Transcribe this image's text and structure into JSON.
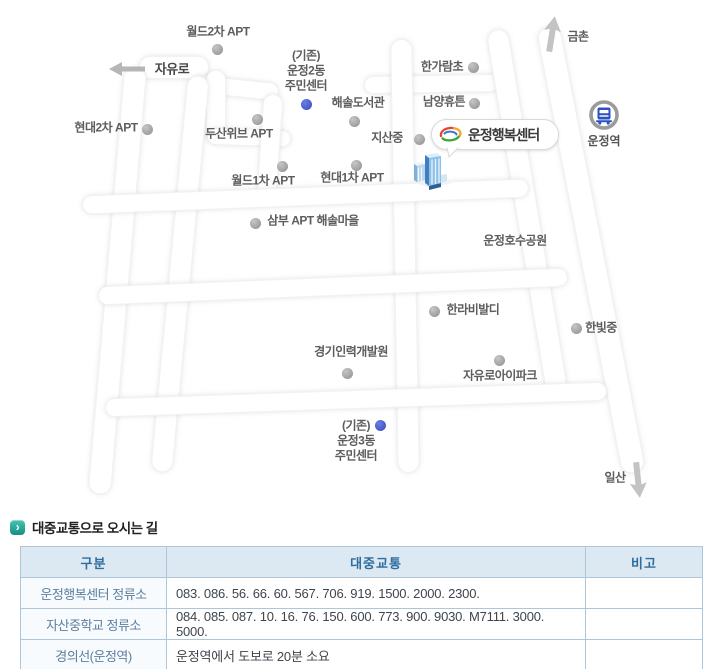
{
  "map": {
    "callout": {
      "label": "운정행복센터"
    },
    "station": {
      "label": "운정역"
    },
    "markers": [
      {
        "id": "world2-apt",
        "text": "월드2차 APT",
        "tx": 218,
        "ty": 32,
        "dx": 217,
        "dy": 49,
        "dot": "gray"
      },
      {
        "id": "jayuro-road",
        "text": "자유로",
        "tx": 172,
        "ty": 69,
        "road": true
      },
      {
        "id": "existing-unjeong2-center",
        "text": "(기존)\n운정2동\n주민센터",
        "tx": 306,
        "ty": 71,
        "dx": 306,
        "dy": 104,
        "dot": "blue"
      },
      {
        "id": "haesol-library",
        "text": "해솔도서관",
        "tx": 358,
        "ty": 103,
        "dx": 354,
        "dy": 121,
        "dot": "gray"
      },
      {
        "id": "hyundai2-apt",
        "text": "현대2차 APT",
        "tx": 106,
        "ty": 128,
        "dx": 147,
        "dy": 129,
        "dot": "gray"
      },
      {
        "id": "doosan-weve-apt",
        "text": "두산위브 APT",
        "tx": 239,
        "ty": 134,
        "dx": 257,
        "dy": 119,
        "dot": "gray"
      },
      {
        "id": "world1-apt",
        "text": "월드1차 APT",
        "tx": 263,
        "ty": 181,
        "dx": 282,
        "dy": 166,
        "dot": "gray"
      },
      {
        "id": "hyundai1-apt",
        "text": "현대1차 APT",
        "tx": 352,
        "ty": 178,
        "dx": 356,
        "dy": 165,
        "dot": "gray"
      },
      {
        "id": "hangaram-elementary",
        "text": "한가람초",
        "tx": 442,
        "ty": 67,
        "dx": 473,
        "dy": 67,
        "dot": "gray"
      },
      {
        "id": "namyang-hueton",
        "text": "남양휴튼",
        "tx": 444,
        "ty": 102,
        "dx": 474,
        "dy": 103,
        "dot": "gray"
      },
      {
        "id": "jisan-middle",
        "text": "지산중",
        "tx": 387,
        "ty": 138,
        "dx": 419,
        "dy": 139,
        "dot": "gray"
      },
      {
        "id": "gimchon",
        "text": "금촌",
        "tx": 578,
        "ty": 37
      },
      {
        "id": "sambu-apt-haesol",
        "text": "삼부 APT 해솔마을",
        "tx": 313,
        "ty": 221,
        "dx": 255,
        "dy": 223,
        "dot": "gray"
      },
      {
        "id": "unjeong-lake-park",
        "text": "운정호수공원",
        "tx": 515,
        "ty": 241
      },
      {
        "id": "halla-vivaldi",
        "text": "한라비발디",
        "tx": 473,
        "ty": 310,
        "dx": 434,
        "dy": 311,
        "dot": "gray"
      },
      {
        "id": "hanbit-middle",
        "text": "한빛중",
        "tx": 601,
        "ty": 328,
        "dx": 576,
        "dy": 328,
        "dot": "gray"
      },
      {
        "id": "jayuro-ipark",
        "text": "자유로아이파크",
        "tx": 500,
        "ty": 376,
        "dx": 499,
        "dy": 360,
        "dot": "gray"
      },
      {
        "id": "gyeonggi-hrd-center",
        "text": "경기인력개발원",
        "tx": 351,
        "ty": 352,
        "dx": 347,
        "dy": 373,
        "dot": "gray"
      },
      {
        "id": "existing-unjeong3-center",
        "text": "(기존)\n운정3동\n주민센터",
        "tx": 356,
        "ty": 441,
        "dx": 380,
        "dy": 425,
        "dot": "blue"
      },
      {
        "id": "ilsan",
        "text": "일산",
        "tx": 615,
        "ty": 478
      }
    ]
  },
  "transport": {
    "heading": "대중교통으로 오시는 길",
    "table": {
      "headers": [
        "구분",
        "대중교통",
        "비고"
      ],
      "rows": [
        {
          "category": "운정행복센터 정류소",
          "transit": "083. 086. 56. 66. 60. 567. 706. 919. 1500. 2000. 2300.",
          "note": ""
        },
        {
          "category": "자산중학교 정류소",
          "transit": "084. 085. 087. 10. 16. 76. 150. 600. 773. 900. 9030. M7111. 3000. 5000.",
          "note": ""
        },
        {
          "category": "경의선(운정역)",
          "transit": "운정역에서 도보로 20분 소요",
          "note": ""
        }
      ]
    }
  },
  "colors": {
    "header_bg": "#dce8f2",
    "header_text": "#2e6da0",
    "table_border": "#8fafc5",
    "inner_border": "#adc6d9",
    "category_text": "#5b7f9e",
    "transit_text": "#3e454c",
    "heading_text": "#222222",
    "heading_icon": "#1fa090",
    "gray_marker": "#949494",
    "blue_marker": "#4152c9",
    "map_label": "#5d5d5d",
    "station_blue": "#2b52c0",
    "building_blue": "#5b9bd5",
    "callout_border": "#d9d9d9",
    "arrow_gray": "#bdbdbd"
  },
  "icons": {
    "heading_bullet": "chevron-right-icon",
    "jayuro_arrow": "arrow-left-icon",
    "gimchon_arrow": "arrow-up-icon",
    "ilsan_arrow": "arrow-down-icon",
    "station_icon": "train-station-icon",
    "building_icon": "office-building-3d-icon",
    "callout_logo": "paju-city-logo"
  }
}
